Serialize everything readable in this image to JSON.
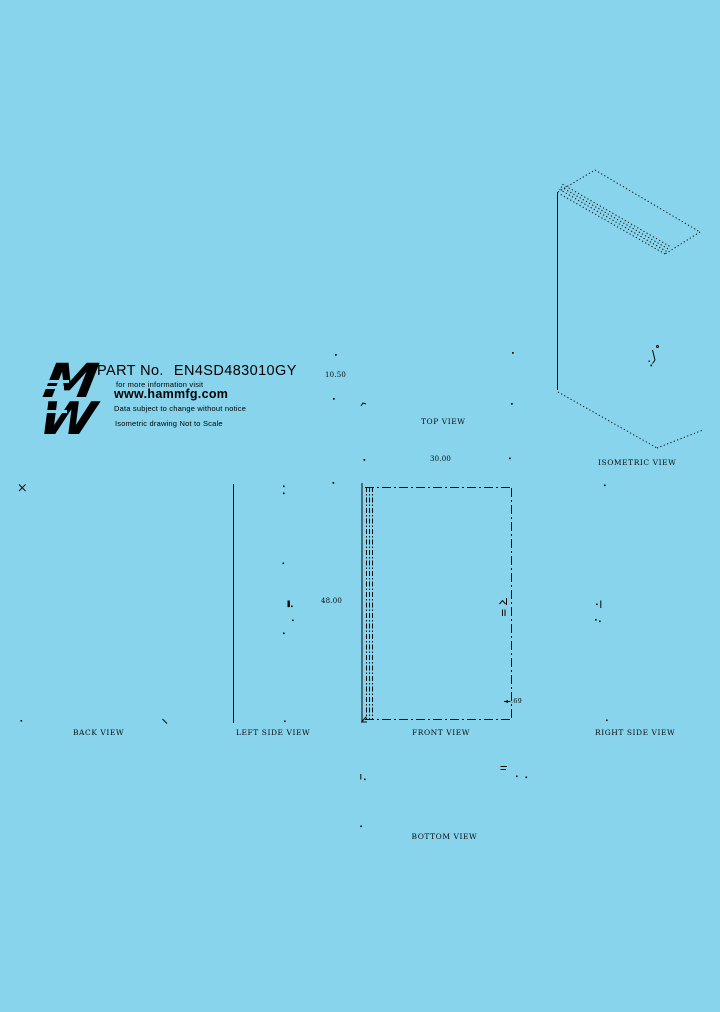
{
  "sheet": {
    "background": "#87D4EC",
    "line_color": "#000000"
  },
  "title_block": {
    "logo_top_glyph": "M",
    "logo_bottom_glyph": "W",
    "part_label": "PART No.",
    "part_number": "EN4SD483010GY",
    "info_line": "for more information visit",
    "website": "www.hammfg.com",
    "disclaimer": "Data subject to change without notice",
    "scale_note": "Isometric drawing Not to Scale"
  },
  "views": {
    "top": {
      "label": "TOP VIEW",
      "width_dim": "30.00",
      "depth_dim": "10.50"
    },
    "front": {
      "label": "FRONT VIEW",
      "height_dim": "48.00",
      "door_offset_dim": ".69"
    },
    "back": {
      "label": "BACK VIEW"
    },
    "left_side": {
      "label": "LEFT SIDE VIEW"
    },
    "right_side": {
      "label": "RIGHT SIDE VIEW"
    },
    "bottom": {
      "label": "BOTTOM VIEW"
    },
    "isometric": {
      "label": "ISOMETRIC VIEW"
    }
  }
}
